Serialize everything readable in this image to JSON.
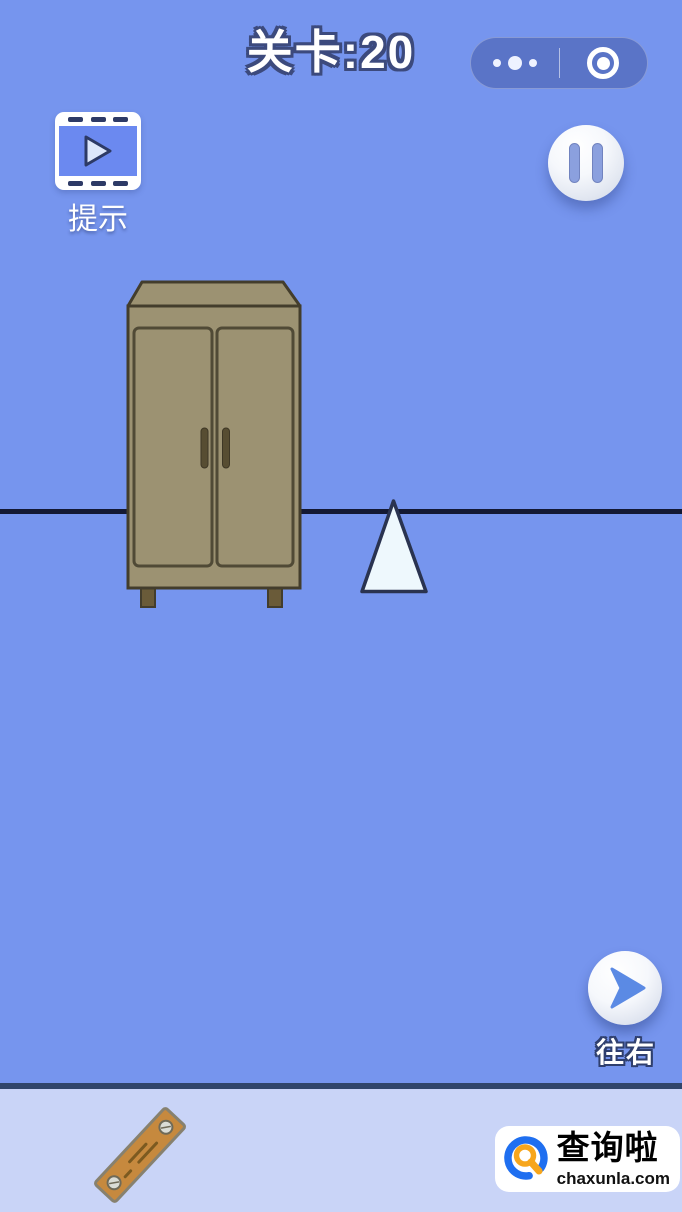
{
  "header": {
    "title": "关卡:20",
    "capsule": {
      "more_icon": "ellipsis-icon",
      "exit_icon": "record-circle-icon"
    }
  },
  "hint_button": {
    "label": "提示",
    "icon": "video-play-icon"
  },
  "pause_button": {
    "icon": "pause-icon"
  },
  "scene": {
    "objects": [
      "wardrobe",
      "white-triangle",
      "ground-line"
    ]
  },
  "move_right_button": {
    "label": "往右",
    "icon": "arrow-right-icon"
  },
  "inventory": {
    "items": [
      "wooden-plank"
    ]
  },
  "watermark": {
    "site_name": "查询啦",
    "site_domain": "chaxunla.com",
    "icon": "magnifier-q-icon"
  },
  "colors": {
    "bg": "#7695ee",
    "capsule-bg": "#5a74c7",
    "text-outline": "#3c4a7d",
    "line": "#141933",
    "wardrobe-body": "#9c9272",
    "wardrobe-outline": "#433d2c",
    "wardrobe-leg": "#6a5b39",
    "wardrobe-handle": "#574d32",
    "triangle-fill": "#eef8fd",
    "triangle-outline": "#2a3350",
    "hint-panel": "#6b89f0",
    "hint-dash": "#2d3a66",
    "pause-bar": "#8ba0de",
    "arrow-blue": "#5b8ae4",
    "bar-bg": "#c9d4f7",
    "bar-border": "#30456b",
    "plank-fill": "#c6893e",
    "plank-outline": "#87816f",
    "logo-blue": "#1f6ff0",
    "logo-orange": "#f7a61c"
  }
}
